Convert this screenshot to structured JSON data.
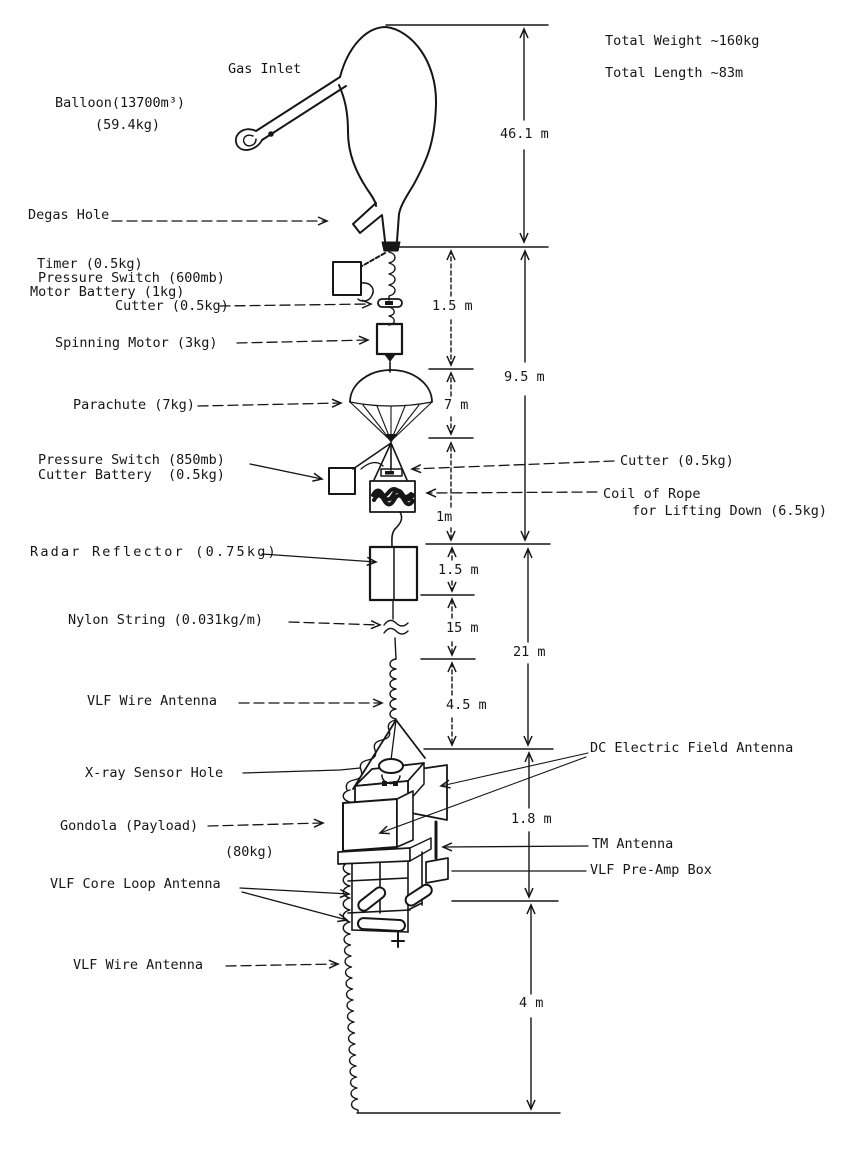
{
  "totals": {
    "weight": "Total Weight ~160kg",
    "length": "Total Length ~83m"
  },
  "parts": {
    "gas_inlet": "Gas Inlet",
    "balloon_name": "Balloon(13700m³)",
    "balloon_weight": "(59.4kg)",
    "degas_hole": "Degas Hole",
    "timer": "Timer (0.5kg)",
    "pressure_switch_600": "Pressure Switch (600mb)",
    "motor_battery": "Motor Battery (1kg)",
    "cutter_upper": "Cutter (0.5kg)",
    "spinning_motor": "Spinning Motor (3kg)",
    "parachute": "Parachute (7kg)",
    "pressure_switch_850": "Pressure Switch (850mb)",
    "cutter_battery": "Cutter Battery  (0.5kg)",
    "cutter_right": "Cutter (0.5kg)",
    "coil_of_rope_1": "Coil of Rope",
    "coil_of_rope_2": "for Lifting Down (6.5kg)",
    "radar_reflector": "Radar Reflector (0.75kg)",
    "nylon_string": "Nylon String (0.031kg/m)",
    "vlf_wire_antenna_upper": "VLF Wire Antenna",
    "xray_sensor_hole": "X-ray Sensor Hole",
    "gondola": "Gondola (Payload)",
    "gondola_weight": "(80kg)",
    "vlf_core_loop_antenna": "VLF Core Loop Antenna",
    "dc_electric_field_antenna": "DC Electric Field Antenna",
    "tm_antenna": "TM Antenna",
    "vlf_preamp_box": "VLF Pre-Amp Box",
    "vlf_wire_antenna_lower": "VLF Wire Antenna"
  },
  "dimensions": {
    "overall_top": "46.1 m",
    "seg_1_5_upper": "1.5 m",
    "group_9_5": "9.5 m",
    "seg_7": "7 m",
    "seg_1": "1m",
    "seg_1_5_mid": "1.5 m",
    "seg_15": "15 m",
    "group_21": "21 m",
    "seg_4_5": "4.5 m",
    "seg_1_8": "1.8 m",
    "seg_4": "4 m"
  }
}
